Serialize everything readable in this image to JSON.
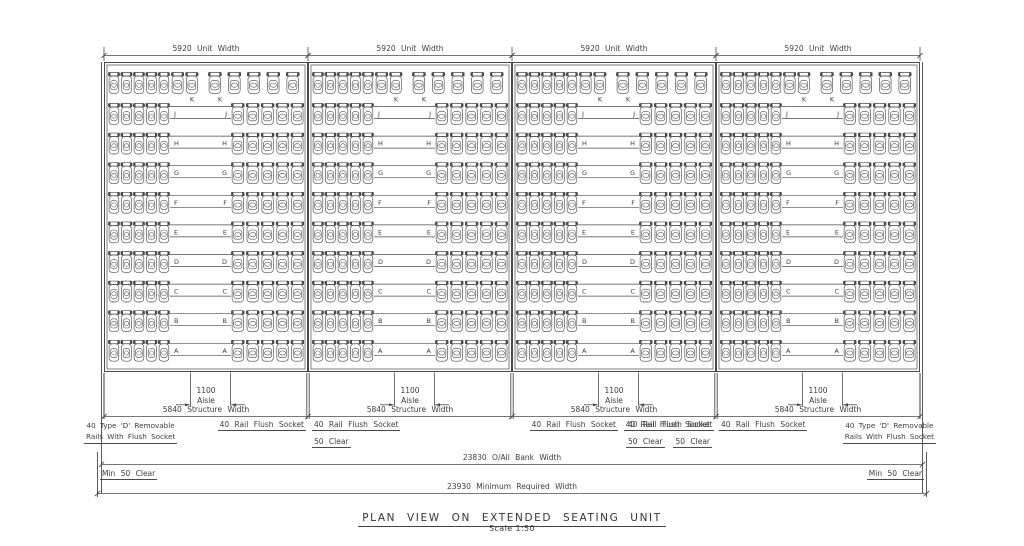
{
  "title": {
    "main": "PLAN VIEW ON EXTENDED SEATING UNIT",
    "scale": "Scale 1:50"
  },
  "seating": {
    "units": 4,
    "rows_per_unit": 10,
    "row_letters_front_to_back": [
      "A",
      "B",
      "C",
      "D",
      "E",
      "F",
      "G",
      "H",
      "J",
      "K"
    ],
    "back_row_letter": "K",
    "seats_left_group": 5,
    "seats_right_group": 5,
    "back_row_extra_seats": 2,
    "back_row_total_seats": 12
  },
  "dims": {
    "unit_width": "5920 Unit Width",
    "structure_width": "5840 Structure Width",
    "aisle_value": "1100",
    "aisle_word": "Aisle",
    "bank_width": "23830 O/All Bank Width",
    "required_width": "23930 Minimum Required Width"
  },
  "annotations": {
    "removable_line1": "40 Type 'D' Removable",
    "removable_line2": "Rails With Flush Socket",
    "rail_flush_socket": "40 Rail Flush Socket",
    "clear_50": "50 Clear",
    "min_50_clear": "Min 50 Clear"
  },
  "colors": {
    "background": "#ffffff",
    "line": "#4a4a4a",
    "text": "#3d3d3d"
  }
}
